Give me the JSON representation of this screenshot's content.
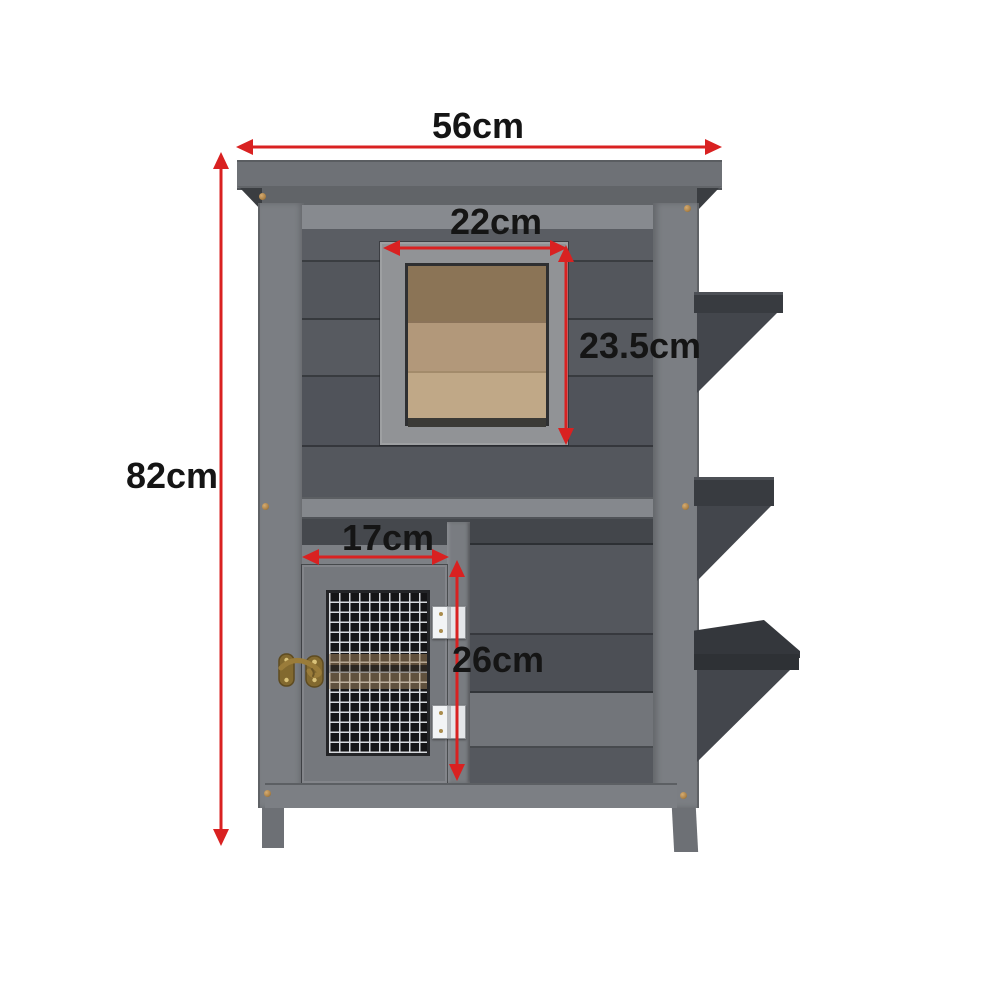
{
  "diagram": {
    "type": "product-dimension-diagram",
    "subject": "two-storey wooden pet hutch with mesh door, upper opening and three side steps",
    "background": "#ffffff",
    "dimensions": {
      "overall_width": "56cm",
      "overall_height": "82cm",
      "window_width": "22cm",
      "window_height": "23.5cm",
      "door_width": "17cm",
      "door_height": "26cm"
    },
    "colors": {
      "arrow_red": "#d92121",
      "label_text": "#151515",
      "hutch_gray": "#53565c",
      "frame_gray": "#85888d",
      "roof_gray": "#6e7176",
      "wood_tan": "#b2987a",
      "step_charcoal": "#383b40",
      "mesh_black": "#141416",
      "mesh_wire": "#d6d9dd",
      "hinge_silver": "#e4e6e9",
      "latch_brass": "#8f7434"
    }
  }
}
